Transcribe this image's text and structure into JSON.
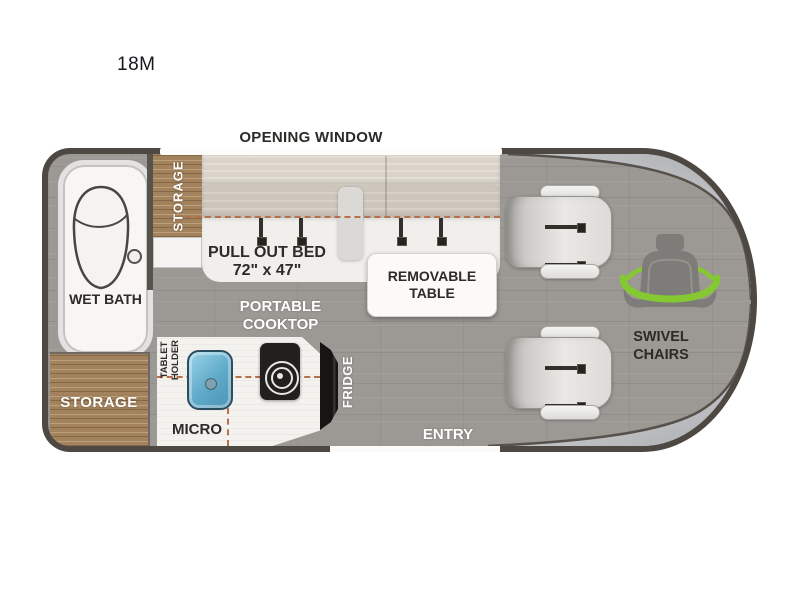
{
  "page": {
    "title": "18M"
  },
  "van": {
    "window_label": "OPENING WINDOW",
    "areas": {
      "wet_bath": "WET BATH",
      "rear_storage": "STORAGE",
      "upper_storage": "STORAGE",
      "bed": "PULL OUT BED",
      "bed_size": "72\" x 47\"",
      "table": "REMOVABLE TABLE",
      "cooktop": "PORTABLE COOKTOP",
      "tablet_holder": "TABLET HOLDER",
      "micro": "MICRO",
      "fridge": "FRIDGE",
      "entry": "ENTRY",
      "swivel_chairs": "SWIVEL CHAIRS"
    },
    "colors": {
      "outline": "#4e4843",
      "floor": "#9c9894",
      "wood": "#a3835d",
      "accent_green": "#85c832",
      "dashed_line": "#b4714c",
      "sink_blue": "#5fa9c9",
      "body_silver": "#c9cbcd"
    },
    "icons": {
      "toilet": "toilet-icon",
      "burner": "cooktop-burner-icon",
      "swivel_seat": "swivel-seat-icon",
      "seatbelt": "seatbelt-icon"
    }
  }
}
